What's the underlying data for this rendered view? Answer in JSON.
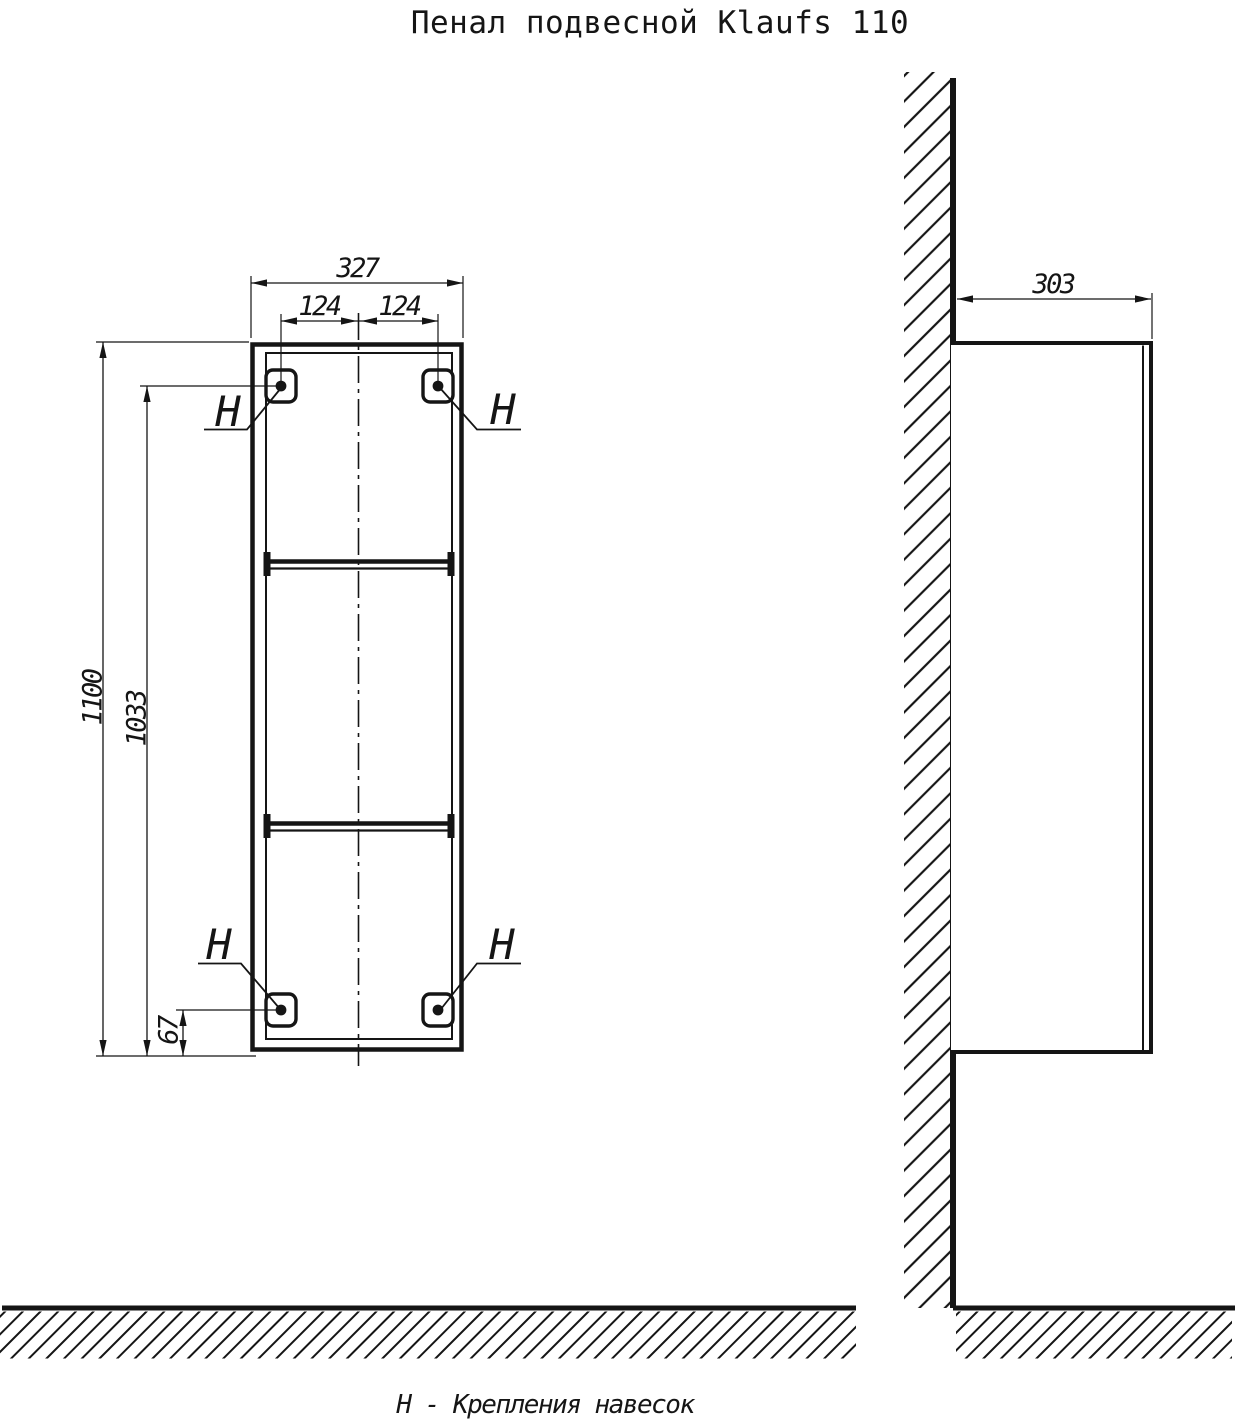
{
  "title": "Пенал подвесной Klaufs 110",
  "footnote": "Н - Крепления навесок",
  "front_view": {
    "dim_width": "327",
    "dim_hole_spacing_left": "124",
    "dim_hole_spacing_right": "124",
    "dim_height": "1100",
    "dim_hole_height": "1033",
    "dim_bottom_hole_offset": "67",
    "hook_labels": [
      "Н",
      "Н",
      "Н",
      "Н"
    ]
  },
  "side_view": {
    "dim_depth": "303"
  },
  "colors": {
    "ink": "#151515",
    "paper": "#ffffff"
  }
}
